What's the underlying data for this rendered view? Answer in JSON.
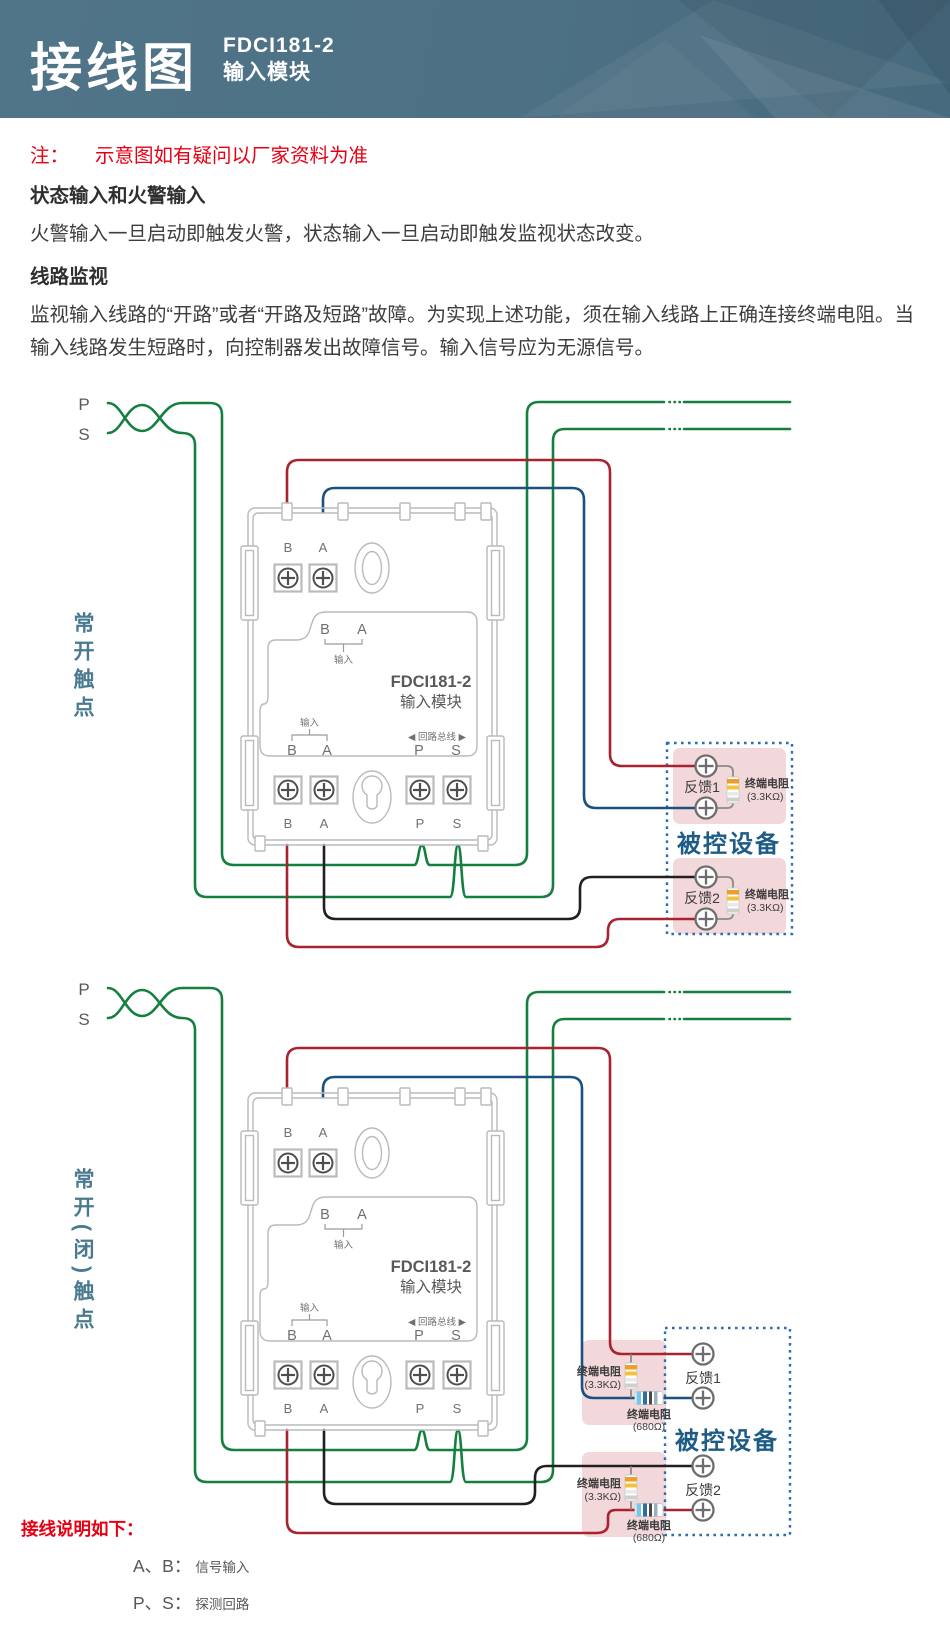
{
  "header": {
    "title": "接线图",
    "model": "FDCI181-2",
    "module_type": "输入模块"
  },
  "note": {
    "label": "注：",
    "text": "示意图如有疑问以厂家资料为准"
  },
  "sections": [
    {
      "heading": "状态输入和火警输入",
      "body": "火警输入一旦启动即触发火警，状态输入一旦启动即触发监视状态改变。"
    },
    {
      "heading": "线路监视",
      "body": "监视输入线路的“开路”或者“开路及短路”故障。为实现上述功能，须在输入线路上正确连接终端电阻。当输入线路发生短路时，向控制器发出故障信号。输入信号应为无源信号。"
    }
  ],
  "loop": {
    "p": "P",
    "s": "S"
  },
  "module": {
    "terminal_b": "B",
    "terminal_a": "A",
    "terminal_p": "P",
    "terminal_s": "S",
    "input_label": "输入",
    "model": "FDCI181-2",
    "type_label": "输入模块",
    "bus_label": "◀ 回路总线 ▶"
  },
  "diagram1": {
    "side_label": "常开触点",
    "device": {
      "title": "被控设备",
      "fb1": "反馈1",
      "fb2": "反馈2",
      "res_label": "终端电阻",
      "res_value": "(3.3KΩ)"
    }
  },
  "diagram2": {
    "side_label": "常开(闭)触点",
    "device": {
      "title": "被控设备",
      "fb1": "反馈1",
      "fb2": "反馈2",
      "res33_label": "终端电阻",
      "res33_value": "(3.3KΩ)",
      "res680_label": "终端电阻",
      "res680_value": "(680Ω)"
    }
  },
  "legend": {
    "title": "接线说明如下：",
    "items": [
      {
        "keys": "A、B：",
        "desc": "信号输入"
      },
      {
        "keys": "P、S：",
        "desc": "探测回路"
      }
    ]
  },
  "colors": {
    "header_bg": "#4d7084",
    "note_red": "#e60012",
    "wire_green": "#157f40",
    "wire_red": "#a8232f",
    "wire_blue": "#1b517e",
    "wire_black": "#231f20",
    "device_border": "#2a6db5",
    "device_pink": "#f2d8da",
    "device_title_color": "#1d5c86",
    "side_label_color": "#4a7a90"
  }
}
